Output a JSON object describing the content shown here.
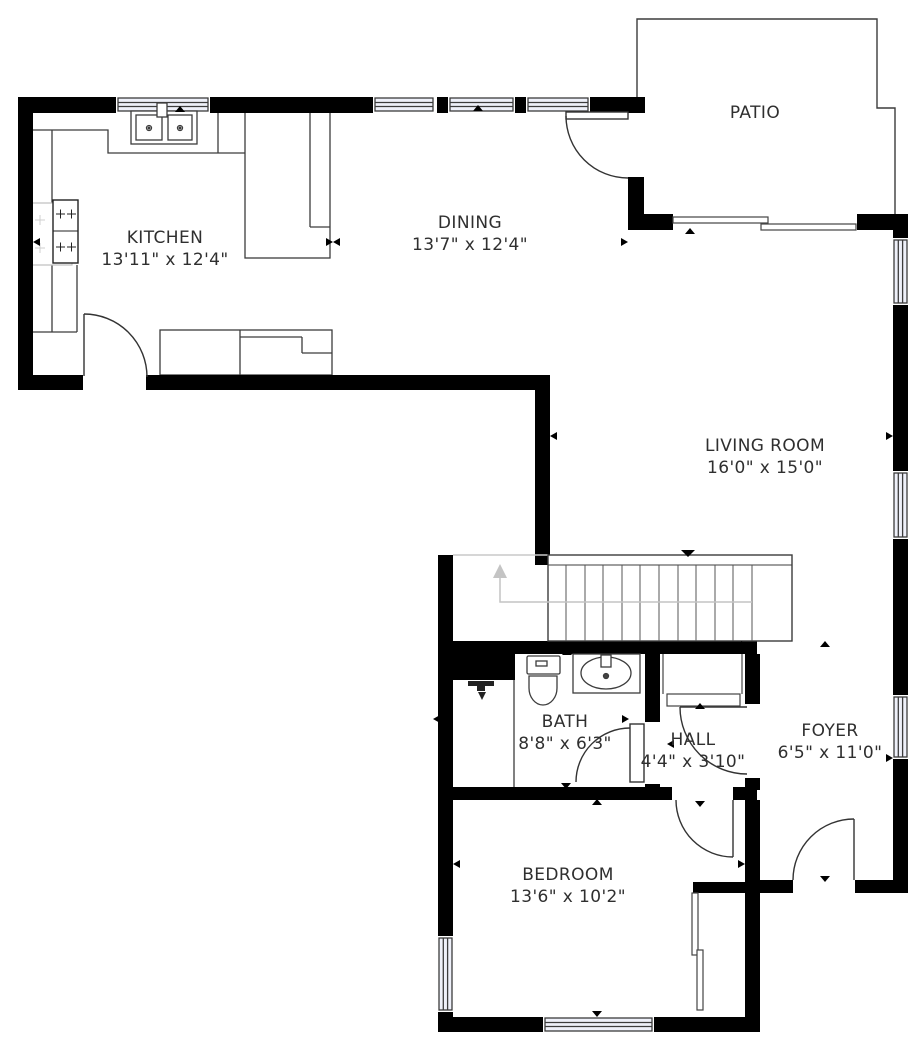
{
  "floorplan": {
    "title": "Apartment floor plan",
    "rooms": [
      {
        "name": "KITCHEN",
        "dims": "13'11\" x 12'4\""
      },
      {
        "name": "DINING",
        "dims": "13'7\" x 12'4\""
      },
      {
        "name": "PATIO",
        "dims": ""
      },
      {
        "name": "LIVING ROOM",
        "dims": "16'0\" x 15'0\""
      },
      {
        "name": "BATH",
        "dims": "8'8\" x 6'3\""
      },
      {
        "name": "HALL",
        "dims": "4'4\" x 3'10\""
      },
      {
        "name": "FOYER",
        "dims": "6'5\" x 11'0\""
      },
      {
        "name": "BEDROOM",
        "dims": "13'6\" x 10'2\""
      }
    ],
    "colors": {
      "wall": "#000000",
      "line": "#3c3c3c",
      "window_fill": "#eef0f9",
      "guide": "#c4c4c4",
      "text": "#2f2f2f"
    }
  }
}
